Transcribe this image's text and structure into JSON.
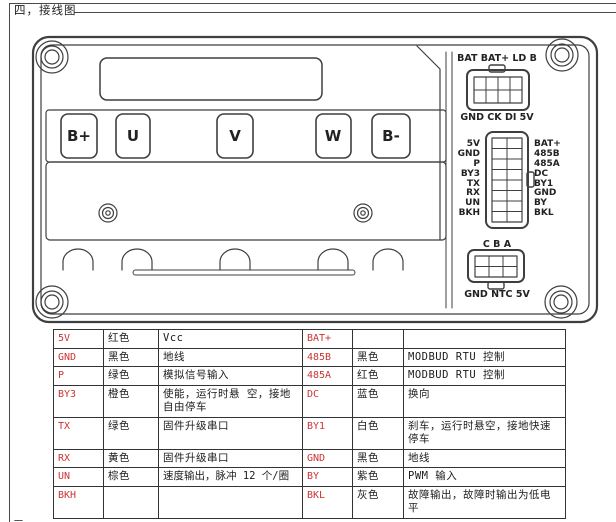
{
  "page": {
    "section_title": "四，接线图",
    "next_section_partial": "五，"
  },
  "palette": {
    "line": "#3f3f3f",
    "pin_red": "#cc3333",
    "text": "#1c1c1c"
  },
  "device": {
    "terminals": [
      "B+",
      "U",
      "V",
      "W",
      "B-"
    ],
    "connector_top": {
      "label_top": "BAT BAT+ LD B",
      "label_bottom": "GND CK DI 5V"
    },
    "connector_mid": {
      "left_pins": [
        "5V",
        "GND",
        "P",
        "BY3",
        "TX",
        "RX",
        "UN",
        "BKH"
      ],
      "right_pins": [
        "BAT+",
        "485B",
        "485A",
        "DC",
        "BY1",
        "GND",
        "BY",
        "BKL"
      ]
    },
    "connector_bottom": {
      "label_top": "C B A",
      "label_bottom": "GND NTC 5V"
    }
  },
  "pin_table": {
    "rows": [
      {
        "pin_l": "5V",
        "color_l": "红色",
        "func_l": "Vcc",
        "pin_r": "BAT+",
        "color_r": "",
        "func_r": ""
      },
      {
        "pin_l": "GND",
        "color_l": "黑色",
        "func_l": "地线",
        "pin_r": "485B",
        "color_r": "黑色",
        "func_r": "MODBUD RTU 控制"
      },
      {
        "pin_l": "P",
        "color_l": "绿色",
        "func_l": "模拟信号输入",
        "pin_r": "485A",
        "color_r": "红色",
        "func_r": "MODBUD RTU 控制"
      },
      {
        "pin_l": "BY3",
        "color_l": "橙色",
        "func_l": "使能，运行时悬 空，接地自由停车",
        "pin_r": "DC",
        "color_r": "蓝色",
        "func_r": "换向"
      },
      {
        "pin_l": "TX",
        "color_l": "绿色",
        "func_l": "固件升级串口",
        "pin_r": "BY1",
        "color_r": "白色",
        "func_r": "刹车，运行时悬空，接地快速停车"
      },
      {
        "pin_l": "RX",
        "color_l": "黄色",
        "func_l": "固件升级串口",
        "pin_r": "GND",
        "color_r": "黑色",
        "func_r": "地线"
      },
      {
        "pin_l": "UN",
        "color_l": "棕色",
        "func_l": "速度输出，脉冲 12 个/圈",
        "pin_r": "BY",
        "color_r": "紫色",
        "func_r": "PWM 输入"
      },
      {
        "pin_l": "BKH",
        "color_l": "",
        "func_l": "",
        "pin_r": "BKL",
        "color_r": "灰色",
        "func_r": "故障输出，故障时输出为低电平"
      }
    ]
  }
}
